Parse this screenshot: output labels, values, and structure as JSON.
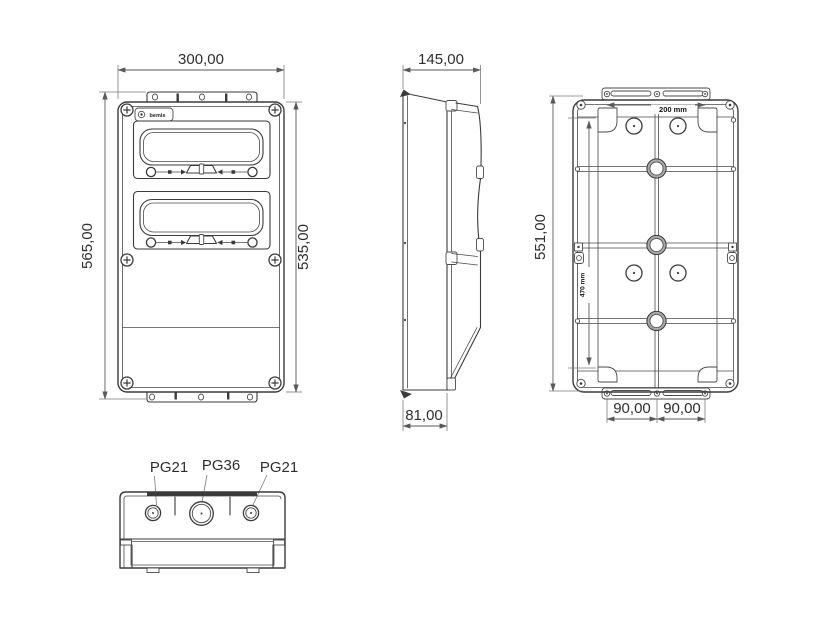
{
  "drawing": {
    "kind": "technical-drawing",
    "subject": "hinged-window distribution enclosure, four orthographic views",
    "line_color": "#3b3b3b",
    "dim_color": "#5a5a5a",
    "background": "#ffffff"
  },
  "front_view": {
    "label": "front-view",
    "logo_text": "bemis",
    "dim_width": "300,00",
    "dim_height_overall": "565,00",
    "dim_height_body": "535,00"
  },
  "side_view": {
    "label": "side-view",
    "dim_depth_overall": "145,00",
    "dim_depth_base": "81,00"
  },
  "rear_view": {
    "label": "rear-view",
    "dim_height": "551,00",
    "dim_fixing_width": "200 mm",
    "dim_fixing_height": "470 mm",
    "dim_bottom_left": "90,00",
    "dim_bottom_right": "90,00"
  },
  "bottom_view": {
    "label": "bottom-view",
    "gland_left": "PG21",
    "gland_center": "PG36",
    "gland_right": "PG21"
  }
}
